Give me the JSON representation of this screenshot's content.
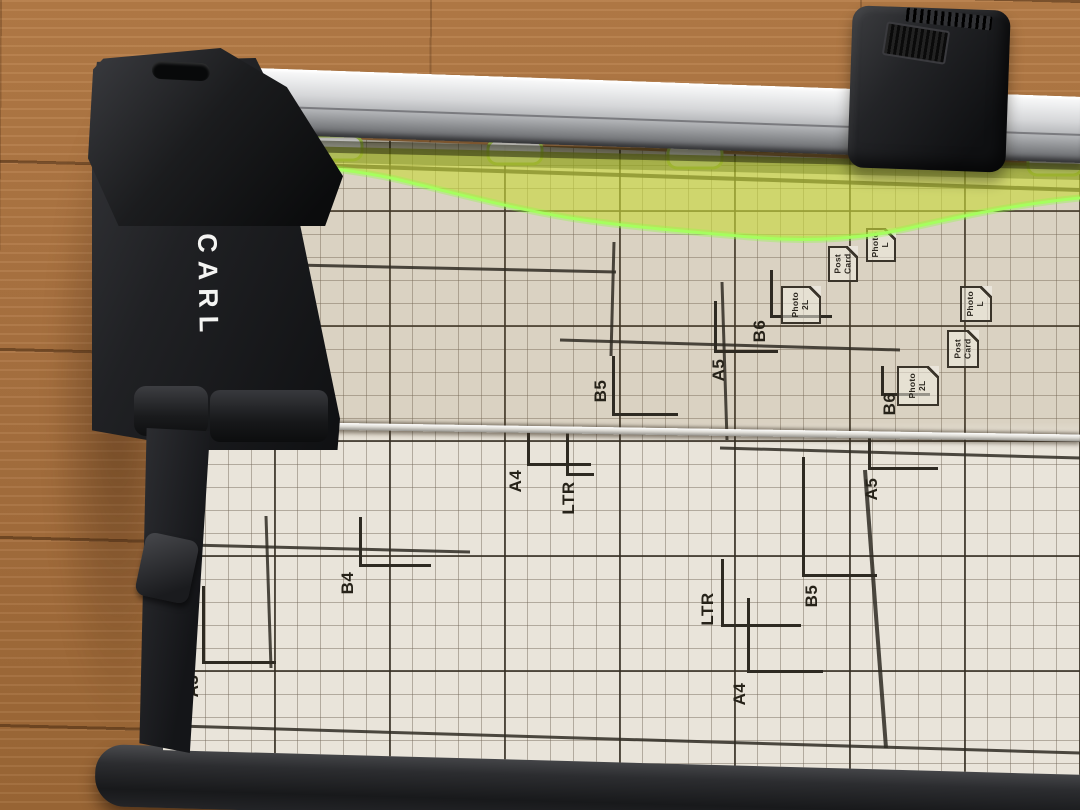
{
  "device": {
    "brand_logo": "CARL",
    "kind": "rotary paper trimmer"
  },
  "colors": {
    "guard_green": "#c8d838",
    "guard_edge_glow": "#8cff3e",
    "mat": "#e9e4da",
    "grid_bold": "#2e2a22",
    "grid_fine": "#8a8070",
    "rail_silver": "#d6d7d9",
    "plastic_black": "#1a1b1d",
    "floor_wood": "#a9713c"
  },
  "mat": {
    "size_marks": [
      {
        "id": "b5-upper",
        "label": "B5",
        "cx": 601,
        "cy": 391,
        "corner": [
          612,
          416
        ],
        "up": 60,
        "right": 66
      },
      {
        "id": "a5-upper",
        "label": "A5",
        "cx": 719,
        "cy": 370,
        "corner": [
          714,
          353
        ],
        "up": 52,
        "right": 64
      },
      {
        "id": "b6-upper-1",
        "label": "B6",
        "cx": 760,
        "cy": 331,
        "corner": [
          770,
          318
        ],
        "up": 48,
        "right": 62
      },
      {
        "id": "b6-upper-2",
        "label": "B6",
        "cx": 890,
        "cy": 404,
        "corner": [
          881,
          396
        ],
        "up": 30,
        "right": 49
      },
      {
        "id": "a3",
        "label": "A3",
        "cx": 193,
        "cy": 686,
        "corner": [
          202,
          664
        ],
        "up": 78,
        "right": 74
      },
      {
        "id": "b4",
        "label": "B4",
        "cx": 348,
        "cy": 583,
        "corner": [
          359,
          567
        ],
        "up": 50,
        "right": 72
      },
      {
        "id": "a4-left",
        "label": "A4",
        "cx": 516,
        "cy": 481,
        "corner": [
          527,
          466
        ],
        "up": 40,
        "right": 64
      },
      {
        "id": "ltr-left",
        "label": "LTR",
        "cx": 569,
        "cy": 498,
        "corner": [
          566,
          476
        ],
        "up": 46,
        "right": 28
      },
      {
        "id": "ltr-right",
        "label": "LTR",
        "cx": 708,
        "cy": 609,
        "corner": [
          721,
          627
        ],
        "up": 68,
        "right": 80
      },
      {
        "id": "a4-right",
        "label": "A4",
        "cx": 740,
        "cy": 694,
        "corner": [
          747,
          673
        ],
        "up": 75,
        "right": 76
      },
      {
        "id": "b5-lower",
        "label": "B5",
        "cx": 812,
        "cy": 596,
        "corner": [
          802,
          577
        ],
        "up": 120,
        "right": 75
      },
      {
        "id": "a5-lower",
        "label": "A5",
        "cx": 872,
        "cy": 489,
        "corner": [
          868,
          470
        ],
        "up": 32,
        "right": 70
      }
    ],
    "icon_tags": [
      {
        "id": "photo-2l-1",
        "lines": [
          "Photo",
          "2L"
        ],
        "x": 781,
        "y": 286,
        "w": 40,
        "h": 38
      },
      {
        "id": "postcard-1",
        "lines": [
          "Post",
          "Card"
        ],
        "x": 828,
        "y": 246,
        "w": 30,
        "h": 36
      },
      {
        "id": "photo-l-1",
        "lines": [
          "Photo",
          "L"
        ],
        "x": 866,
        "y": 228,
        "w": 30,
        "h": 34
      },
      {
        "id": "photo-2l-2",
        "lines": [
          "Photo",
          "2L"
        ],
        "x": 897,
        "y": 366,
        "w": 42,
        "h": 40
      },
      {
        "id": "postcard-2",
        "lines": [
          "Post",
          "Card"
        ],
        "x": 947,
        "y": 330,
        "w": 32,
        "h": 38
      },
      {
        "id": "photo-l-2",
        "lines": [
          "Photo",
          "L"
        ],
        "x": 960,
        "y": 286,
        "w": 32,
        "h": 36
      }
    ],
    "print_lines": [
      [
        250,
        163,
        1080,
        190,
        4
      ],
      [
        250,
        264,
        616,
        272,
        3
      ],
      [
        248,
        180,
        250,
        418,
        3
      ],
      [
        560,
        340,
        900,
        350,
        3
      ],
      [
        720,
        448,
        1080,
        458,
        3
      ],
      [
        865,
        470,
        886,
        748,
        4
      ],
      [
        150,
        544,
        470,
        552,
        3
      ],
      [
        266,
        516,
        271,
        668,
        3
      ],
      [
        178,
        726,
        1080,
        753,
        3
      ],
      [
        614,
        242,
        611,
        356,
        3
      ],
      [
        722,
        282,
        727,
        440,
        3
      ]
    ]
  }
}
